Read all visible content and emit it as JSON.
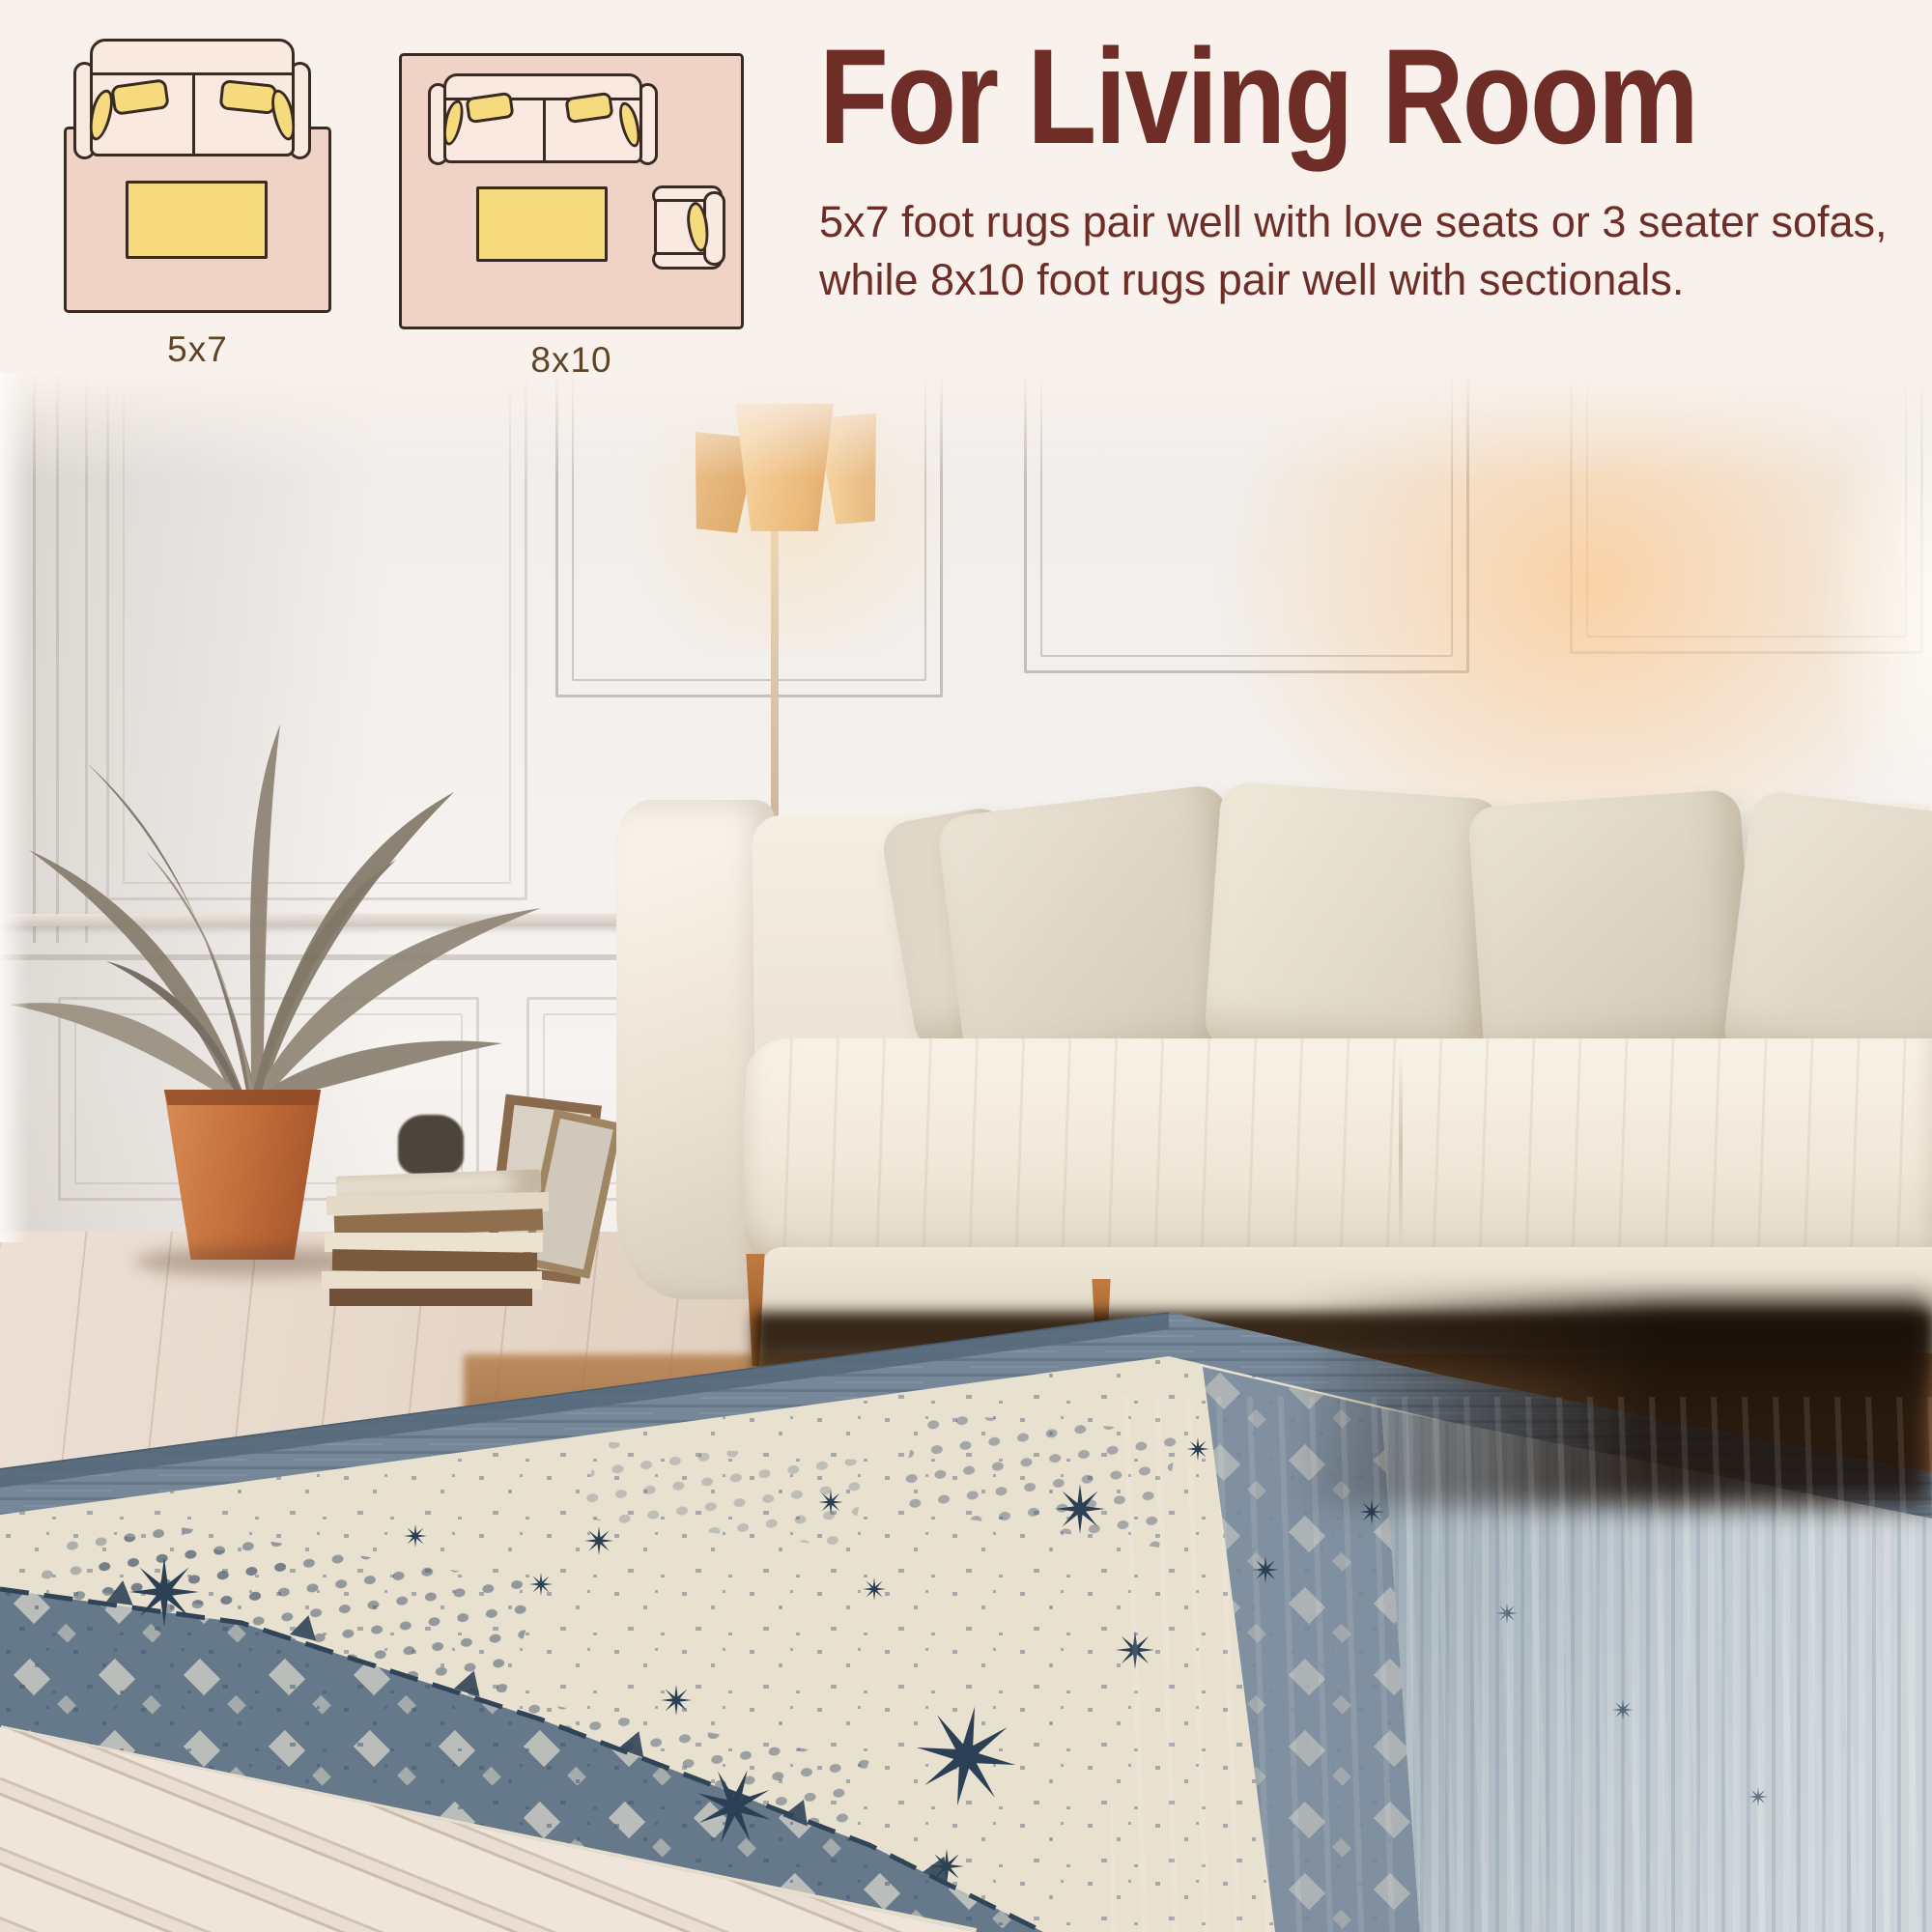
{
  "page": {
    "background_color": "#f8f1ec",
    "kind": "rug size guide infographic over living room photo"
  },
  "header": {
    "title": "For Living Room",
    "description": "5x7 foot rugs pair well with love seats or 3 seater sofas, while 8x10 foot rugs pair well with sectionals.",
    "title_color": "#6e2d26"
  },
  "size_diagrams": {
    "items": [
      {
        "label": "5x7",
        "furniture": [
          "loveseat-sofa-top-view",
          "coffee-table"
        ]
      },
      {
        "label": "8x10",
        "furniture": [
          "three-seat-sofa-top-view",
          "coffee-table",
          "armchair-top-view"
        ]
      }
    ],
    "rug_color": "#f0d3c7",
    "sofa_fill": "#f9e9e1",
    "pillow_color": "#f6db7e",
    "outline_color": "#3a2b22",
    "label_color": "#5e4527"
  },
  "scene": {
    "elements": [
      "paneled-wall",
      "floor-lamp",
      "dried-palm-plant",
      "terracotta-pot",
      "stacked-books",
      "leaning-picture-frames",
      "cream-sofa",
      "throw-pillows",
      "wood-floor",
      "patterned-area-rug"
    ],
    "rug_colors": {
      "field": "#e9e1d0",
      "border": "#66798b",
      "motifs": "#2c4055",
      "faded_side": "#b9c3c9"
    },
    "sofa_color": "#f2ecdf",
    "lamp_shade_color": "#e7b078",
    "pot_color": "#c06a38"
  }
}
